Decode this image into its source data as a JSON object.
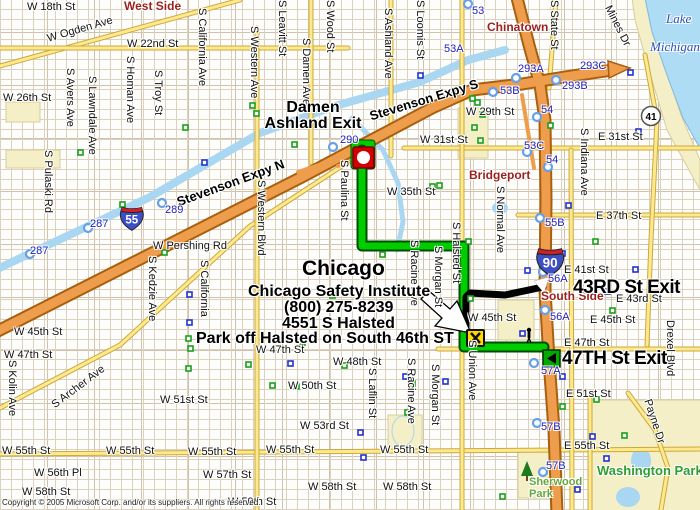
{
  "annotation": {
    "city": "Chicago",
    "line1": "Chicago Safety Institute",
    "line2": "(800) 275-8239",
    "line3": "4551 S Halsted",
    "line4": "Park off Halsted on South 46th ST"
  },
  "exits_big": {
    "damen_line1": "Damen",
    "damen_line2": "Ashland Exit",
    "exit43": "43RD St Exit",
    "exit47": "47TH St Exit"
  },
  "districts": [
    "West Side",
    "Chinatown",
    "Bridgeport",
    "South Side"
  ],
  "water_labels": [
    "Lake",
    "Michigan"
  ],
  "park_labels": [
    "Washington Park",
    "Sherwood",
    "Park"
  ],
  "streets_h": [
    "W 18th St",
    "W 22nd St",
    "W 26th St",
    "W 29th St",
    "W 31st St",
    "W 35th St",
    "W Pershing Rd",
    "E 31st St",
    "E 37th St",
    "E 41st St",
    "E 43rd St",
    "E 45th St",
    "W 45th St",
    "W 45th St",
    "W 47th St",
    "E 47th St",
    "W 47th St",
    "W 48th St",
    "W 50th St",
    "W 51st St",
    "E 51st St",
    "W 53rd St",
    "W 55th St",
    "W 55th St",
    "W 55th St",
    "W 55th St",
    "W 55th St",
    "E 55th St",
    "W 56th Pl",
    "W 57th St",
    "W 58th St",
    "W 58th St",
    "W 58th St",
    "W 59th St"
  ],
  "streets_v": [
    "S Pulaski Rd",
    "S Kolin Ave",
    "S Avers Ave",
    "S Lawndale Ave",
    "S Homan Ave",
    "S Troy St",
    "S California Ave",
    "S California",
    "S Kedzie Ave",
    "S Western Ave",
    "S Western Blvd",
    "S Leavitt St",
    "S Damen Ave",
    "S Wood St",
    "S Ashland Ave",
    "S Loomis St",
    "S Paulina St",
    "S Racine Ave",
    "S Morgan St",
    "S Halsted St",
    "S Normal Ave",
    "S Indiana Ave",
    "S State St",
    "S Laflin St",
    "S Racine Ave",
    "S Morgan St",
    "S Union Ave",
    "Drexel Blvd"
  ],
  "streets_diag": [
    "W Ogden Ave",
    "Stevenson Expy N",
    "Stevenson Expy S",
    "Mines Dr",
    "S Archer Ave",
    "Payne Dr"
  ],
  "exit_numbers": [
    "287",
    "287",
    "289",
    "290",
    "53",
    "53A",
    "293A",
    "293B",
    "293C",
    "53B",
    "54",
    "53C",
    "54",
    "55B",
    "56A",
    "56A",
    "57A",
    "57B",
    "57B"
  ],
  "shields": {
    "i55": "55",
    "i90": "90",
    "us41": "41"
  },
  "copyright": "Copyright © 2005 Microsoft Corp. and/or its suppliers. All rights reserved."
}
